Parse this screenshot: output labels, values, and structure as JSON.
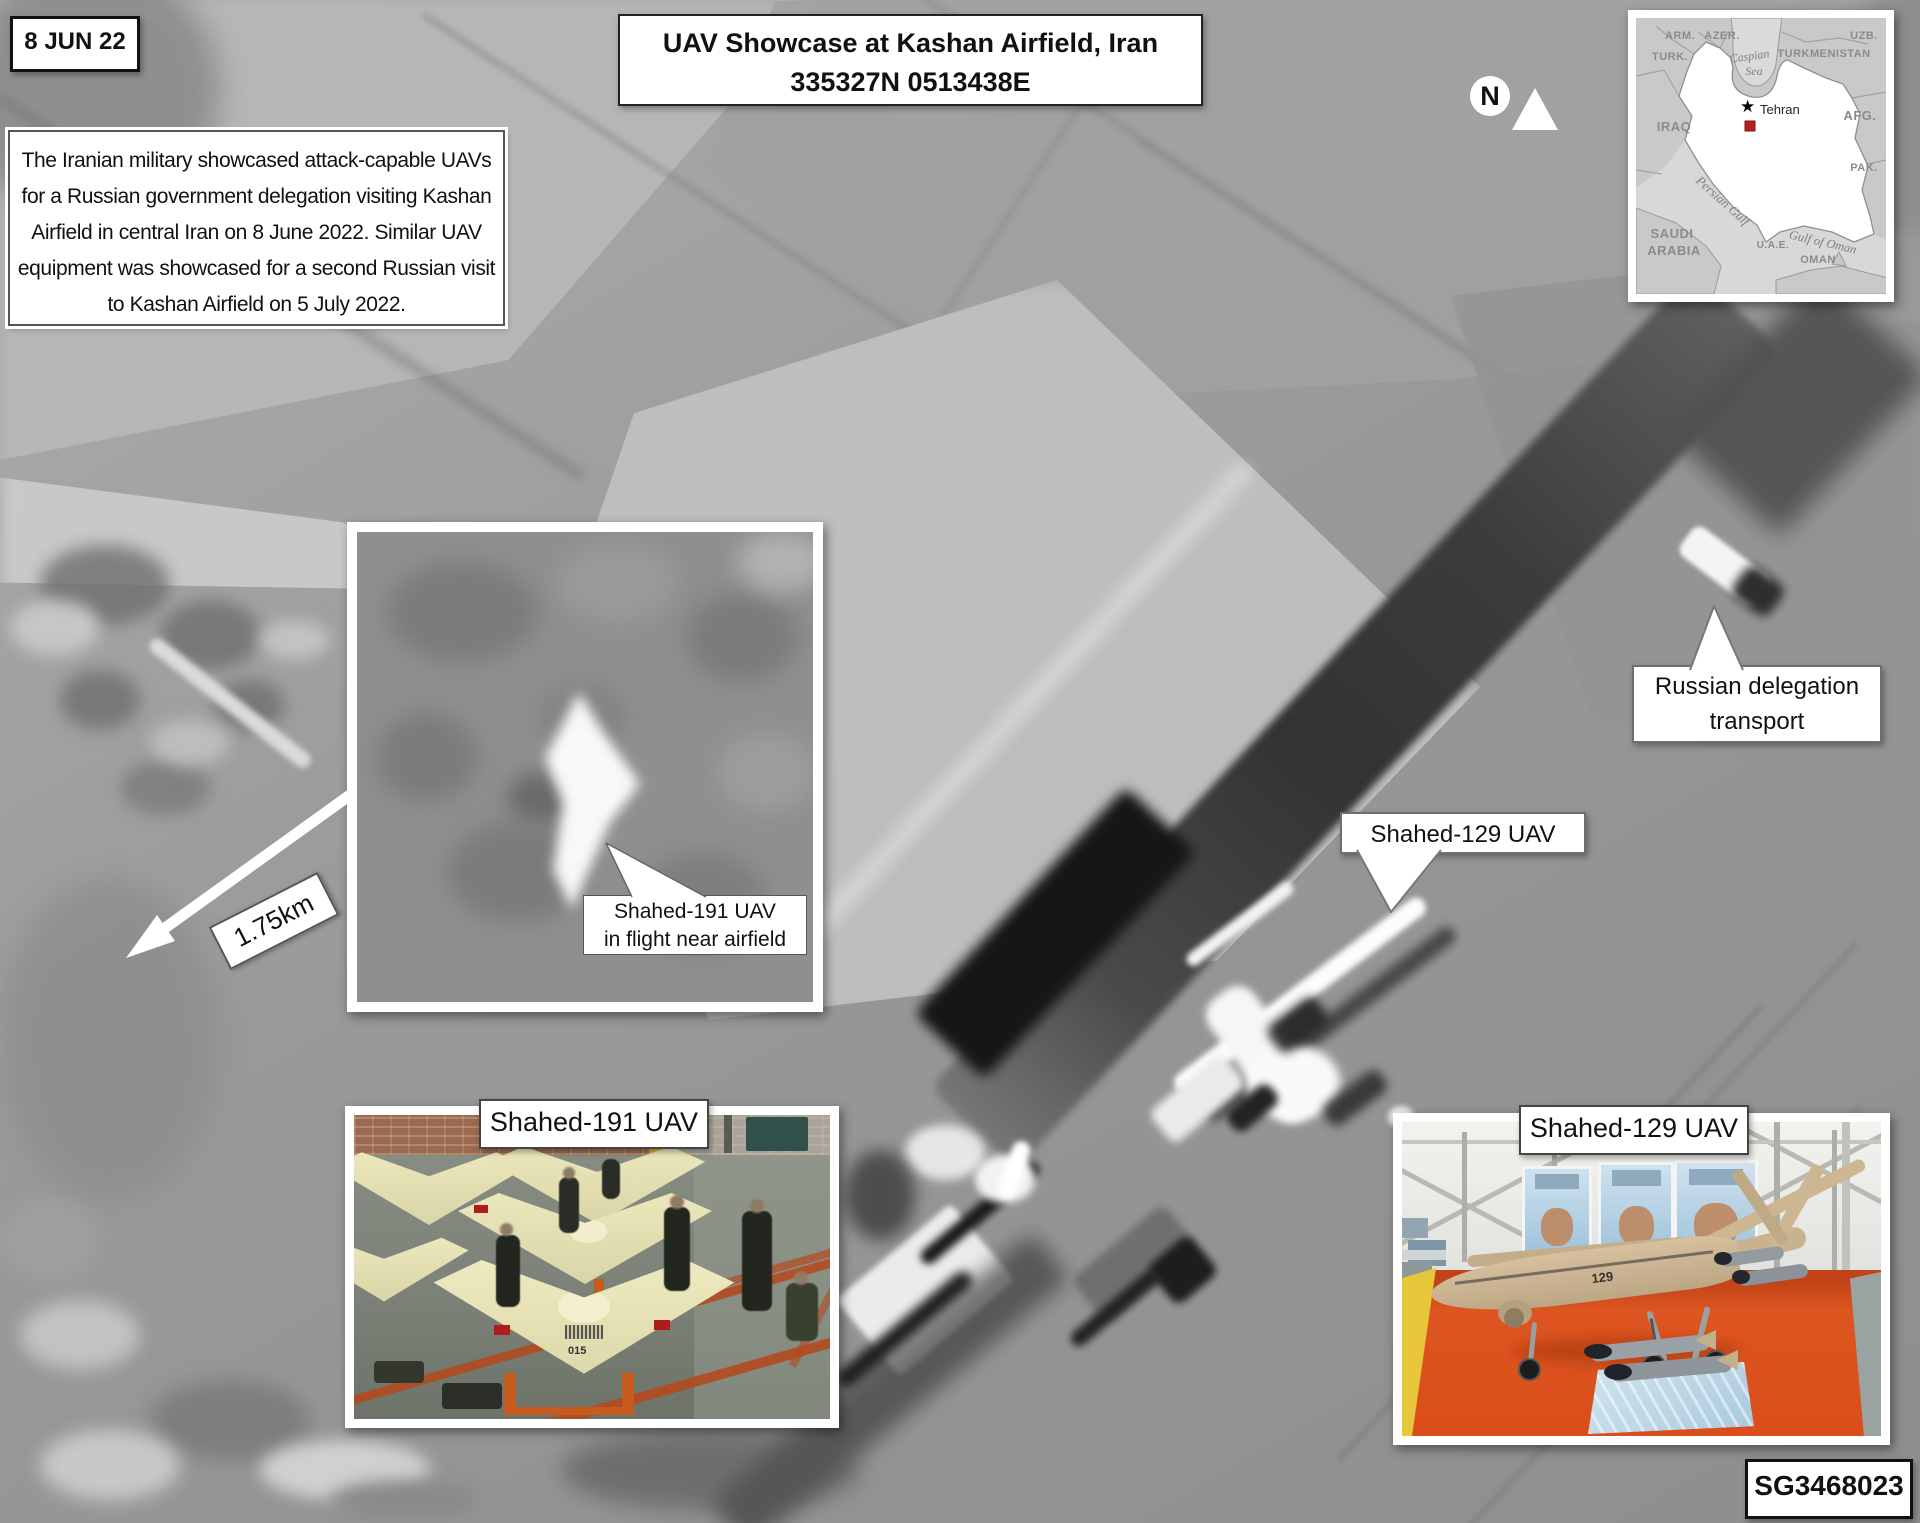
{
  "header": {
    "date_label": "8 JUN 22",
    "title_line1": "UAV Showcase at Kashan Airfield, Iran",
    "title_line2": "335327N 0513438E",
    "description_lines": [
      "The Iranian military showcased attack-capable UAVs",
      "for a Russian government delegation visiting Kashan",
      "Airfield in central Iran on 8 June 2022. Similar UAV",
      "equipment was showcased for a second Russian visit",
      "to Kashan Airfield on 5 July 2022."
    ]
  },
  "compass": {
    "north_label": "N"
  },
  "map_inset": {
    "countries": {
      "armenia": "ARM.",
      "azerbaijan": "AZER.",
      "turkey": "TURK.",
      "uzbekistan": "UZB.",
      "turkmenistan": "TURKMENISTAN",
      "iraq": "IRAQ",
      "afghanistan": "AFG.",
      "pakistan": "PAK.",
      "saudi_line1": "SAUDI",
      "saudi_line2": "ARABIA",
      "uae": "U.A.E.",
      "oman": "OMAN"
    },
    "water": {
      "caspian_line1": "Caspian",
      "caspian_line2": "Sea",
      "persian_gulf": "Persian Gulf",
      "gulf_of_oman": "Gulf of Oman"
    },
    "capital_city": "Tehran",
    "location_marker_color": "#b82020"
  },
  "callouts": {
    "scale_label": "1.75km",
    "inflight_line1": "Shahed-191 UAV",
    "inflight_line2": "in flight near airfield",
    "transport_line1": "Russian delegation",
    "transport_line2": "transport",
    "shahed129_ground_label": "Shahed-129 UAV"
  },
  "photo_insets": {
    "shahed191_label": "Shahed-191 UAV",
    "shahed191_tail_number": "015",
    "shahed129_label": "Shahed-129 UAV",
    "shahed129_tail_number": "129"
  },
  "footer": {
    "graphic_id": "SG3468023"
  }
}
